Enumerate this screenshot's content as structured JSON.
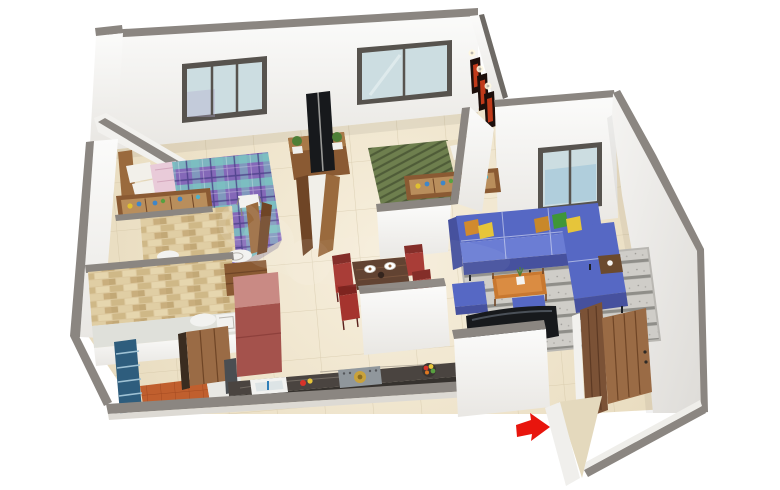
{
  "scene": {
    "kind": "3D isometric floor plan render",
    "unit": "2 BHK apartment",
    "background": "#ffffff",
    "watermark_present": true
  },
  "palette": {
    "wall_face": "#f7f6f4",
    "wall_shade": "#e8e6e2",
    "wall_cap": "#8b8681",
    "wall_cap_dark": "#6e6a65",
    "floor_line": "#cbbd9c",
    "window_frame": "#57534e",
    "window_glass": "#ccdde1",
    "brick_bg": "#dcc89e",
    "plaid_base": "#8468b8",
    "plaid_teal": "#7cc8c2",
    "pink_sheet": "#e9cbd9",
    "pillow_white": "#f2f0ea",
    "green_bed": "#6e7f4e",
    "green_bed_dark": "#4f5c38",
    "cream_sheet": "#eadfc3",
    "wood": "#9a6a3d",
    "wood_dark": "#6f4526",
    "cabinet_wood": "#8a5a33",
    "shelf_wood": "#b98e5c",
    "sofa_blue": "#5668c4",
    "sofa_blue_dark": "#46519e",
    "sofa_blue_light": "#6b7dd4",
    "pillow_orange": "#d08a2e",
    "pillow_yellow": "#e6c53a",
    "pillow_green": "#3f9638",
    "pillow_mustard": "#c8882a",
    "rug_base": "#cfcdc8",
    "rug_stripe": "#84827e",
    "coffee_table": "#c87830",
    "side_table": "#6b4a2e",
    "dining_table": "#5b3a28",
    "chair_red": "#a5342e",
    "chair_red_dark": "#7e241f",
    "fridge_front": "#a4524c",
    "fridge_top": "#c98a84",
    "counter_top": "#4a4440",
    "counter_face": "#36322e",
    "hob_gray": "#90979c",
    "hob_brass": "#c9a23b",
    "tile_orange": "#c05f2e",
    "grill_blue": "#2e5d7d",
    "tv_black": "#17191c",
    "door_wood": "#7b5236",
    "door_wood_light": "#9a6b45",
    "arrow_red": "#e8150d",
    "art_frame": "#1d0f0b",
    "art_red": "#c03a1a",
    "plant_green": "#4e7f37",
    "fixture_white": "#f2f2f0",
    "bath_floor": "#dfe0da"
  },
  "rooms": [
    {
      "id": "master-bedroom",
      "label": "Master Bedroom"
    },
    {
      "id": "bedroom-2",
      "label": "Bedroom 2"
    },
    {
      "id": "living-room",
      "label": "Living Room"
    },
    {
      "id": "dining-area",
      "label": "Dining Area"
    },
    {
      "id": "kitchen",
      "label": "Kitchen"
    },
    {
      "id": "bathroom-1",
      "label": "Bathroom 1"
    },
    {
      "id": "bathroom-2",
      "label": "Bathroom 2"
    },
    {
      "id": "utility-balcony",
      "label": "Utility Balcony"
    },
    {
      "id": "foyer-entrance",
      "label": "Entrance Foyer"
    }
  ],
  "furniture": {
    "master_bedroom": [
      "double bed with purple plaid duvet",
      "white pillows",
      "pink sheet",
      "wooden headboard",
      "dressing shelf with bottles",
      "white stool"
    ],
    "bedroom_2": [
      "double bed with green ribbed duvet",
      "white pillows",
      "wooden headboard",
      "dressing shelf with bottles",
      "three wall art frames",
      "spotlights"
    ],
    "living_room": [
      "blue L-shaped sofa",
      "accent pillows",
      "two blue ottomans",
      "wooden coffee table with plant",
      "dark side table",
      "striped area rug",
      "television"
    ],
    "dining_area": [
      "dark wooden dining table",
      "two set plates",
      "red upholstered chairs"
    ],
    "kitchen": [
      "dark marble counter",
      "sink with blue tap",
      "gas hob with brass plate",
      "fruit bowl",
      "maroon refrigerator",
      "tall wooden cabinet",
      "wooden door"
    ],
    "bathroom_1": [
      "stone tiled walls",
      "toilet",
      "wash basin"
    ],
    "bathroom_2": [
      "stone tiled walls",
      "toilet",
      "shower tray"
    ],
    "utility_balcony": [
      "terracotta tile floor",
      "blue window grill",
      "wooden door"
    ],
    "foyer_entrance": [
      "open wooden double door",
      "door step"
    ]
  },
  "tv_unit": [
    "back-to-back TV panels",
    "wooden media cabinet",
    "two potted plants",
    "angled wooden privacy screens"
  ],
  "annotations": {
    "entrance_arrow": {
      "shape": "solid arrow pointing right",
      "color": "#e8150d",
      "meaning": "main entrance"
    }
  }
}
